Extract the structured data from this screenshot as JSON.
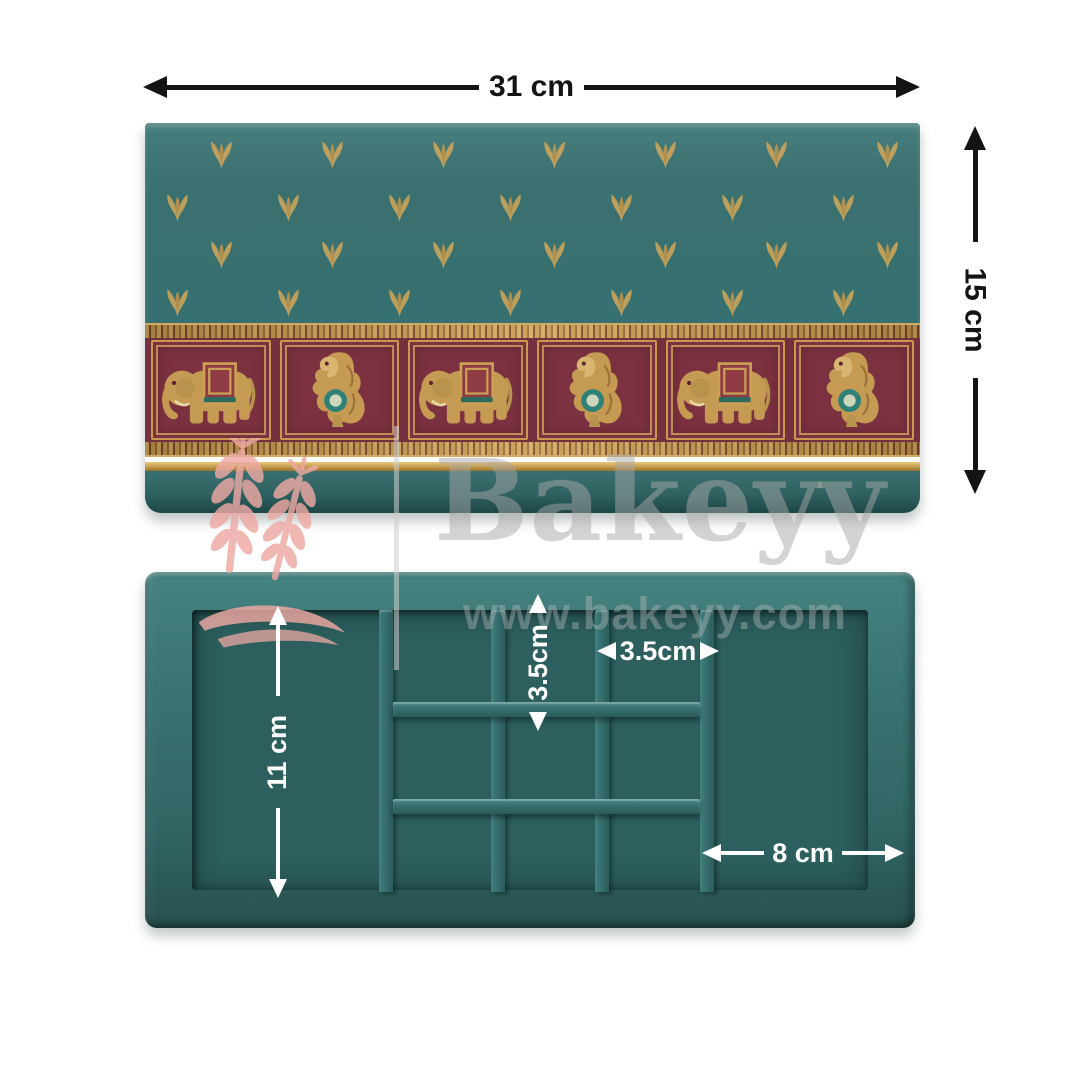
{
  "page": {
    "background": "#ffffff"
  },
  "dimensions": {
    "top_width": {
      "label": "31 cm"
    },
    "side_height": {
      "label": "15 cm"
    },
    "inner_height": {
      "label": "11 cm"
    },
    "cell_height": {
      "label": "3.5cm"
    },
    "cell_width": {
      "label": "3.5cm"
    },
    "compartment_width": {
      "label": "8 cm"
    }
  },
  "watermark": {
    "brand": "Bakeyy",
    "url": "www.bakeyy.com",
    "logo_icon": "wheat-logo"
  },
  "product": {
    "lid": {
      "pattern_icon": "leaf-sprig-motif",
      "band": {
        "panels": [
          {
            "icon": "elephant-motif"
          },
          {
            "icon": "yali-motif"
          },
          {
            "icon": "elephant-motif"
          },
          {
            "icon": "yali-motif"
          },
          {
            "icon": "elephant-motif"
          },
          {
            "icon": "yali-motif"
          }
        ]
      }
    },
    "tray": {
      "vertical_dividers": 4,
      "horizontal_dividers": 2,
      "small_cells": 9
    }
  },
  "colors": {
    "teal-lid": "#3b7170",
    "teal-wall": "#3a7473",
    "teal-floor": "#2c5f5e",
    "maroon": "#74303f",
    "maroon-panel": "#7b3140",
    "gold": "#c59a52",
    "dim-dark": "#141414",
    "dim-light": "#ffffff",
    "wm-pink": "#eea9a3"
  }
}
